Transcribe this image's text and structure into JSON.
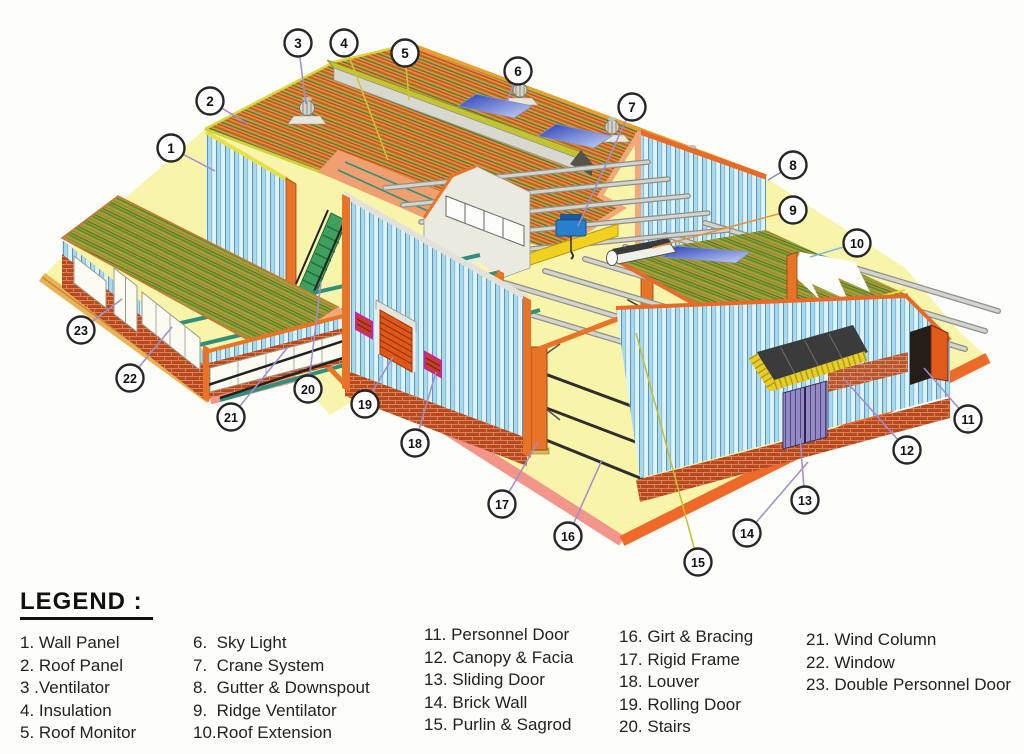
{
  "legend": {
    "heading": "LEGEND :",
    "columns": [
      {
        "items": [
          "1. Wall Panel",
          "2. Roof Panel",
          "3 .Ventilator",
          "4. Insulation",
          "5. Roof Monitor"
        ]
      },
      {
        "items": [
          "6.  Sky Light",
          "7.  Crane System",
          "8.  Gutter & Downspout",
          "9.  Ridge Ventilator",
          "10.Roof Extension"
        ]
      },
      {
        "items": [
          "11. Personnel Door",
          "12. Canopy & Facia",
          "13. Sliding Door",
          "14. Brick Wall",
          "15. Purlin & Sagrod"
        ]
      },
      {
        "items": [
          "16. Girt & Bracing",
          "17. Rigid Frame",
          "18. Louver",
          "19. Rolling Door",
          "20. Stairs"
        ]
      },
      {
        "items": [
          "21. Wind Column",
          "22. Window",
          "23. Double Personnel Door"
        ]
      }
    ]
  },
  "callouts": [
    {
      "num": "1",
      "label": "Wall Panel",
      "cx": 171,
      "cy": 148,
      "tx": 215,
      "ty": 171,
      "line": "#a08cd0"
    },
    {
      "num": "2",
      "label": "Roof Panel",
      "cx": 210,
      "cy": 101,
      "tx": 248,
      "ty": 124,
      "line": "#a08cd0"
    },
    {
      "num": "3",
      "label": "Ventilator",
      "cx": 298,
      "cy": 43,
      "tx": 306,
      "ty": 104,
      "line": "#a08cd0"
    },
    {
      "num": "4",
      "label": "Insulation",
      "cx": 344,
      "cy": 43,
      "tx": 388,
      "ty": 160,
      "line": "#d2c430"
    },
    {
      "num": "5",
      "label": "Roof Monitor",
      "cx": 405,
      "cy": 53,
      "tx": 409,
      "ty": 100,
      "line": "#d2c430"
    },
    {
      "num": "6",
      "label": "Sky Light",
      "cx": 518,
      "cy": 71,
      "tx": 507,
      "ty": 102,
      "line": "#a08cd0"
    },
    {
      "num": "7",
      "label": "Crane System",
      "cx": 632,
      "cy": 107,
      "tx": 578,
      "ty": 226,
      "line": "#a08cd0"
    },
    {
      "num": "8",
      "label": "Gutter & Downspout",
      "cx": 793,
      "cy": 165,
      "tx": 768,
      "ty": 180,
      "line": "#8a8ad0"
    },
    {
      "num": "9",
      "label": "Ridge Ventilator",
      "cx": 793,
      "cy": 210,
      "tx": 652,
      "ty": 248,
      "line": "#e8913c"
    },
    {
      "num": "10",
      "label": "Roof Extension",
      "cx": 857,
      "cy": 243,
      "tx": 810,
      "ty": 257,
      "line": "#7ab8e0"
    },
    {
      "num": "11",
      "label": "Personnel Door",
      "cx": 968,
      "cy": 419,
      "tx": 924,
      "ty": 368,
      "line": "#a08cd0"
    },
    {
      "num": "12",
      "label": "Canopy & Facia",
      "cx": 907,
      "cy": 450,
      "tx": 845,
      "ty": 380,
      "line": "#a08cd0"
    },
    {
      "num": "13",
      "label": "Sliding Door",
      "cx": 805,
      "cy": 500,
      "tx": 800,
      "ty": 438,
      "line": "#a08cd0"
    },
    {
      "num": "14",
      "label": "Brick Wall",
      "cx": 747,
      "cy": 533,
      "tx": 808,
      "ty": 462,
      "line": "#a08cd0"
    },
    {
      "num": "15",
      "label": "Purlin & Sagrod",
      "cx": 698,
      "cy": 562,
      "tx": 636,
      "ty": 333,
      "line": "#c6c030"
    },
    {
      "num": "16",
      "label": "Girt & Bracing",
      "cx": 568,
      "cy": 536,
      "tx": 602,
      "ty": 460,
      "line": "#a08cd0"
    },
    {
      "num": "17",
      "label": "Rigid Frame",
      "cx": 502,
      "cy": 504,
      "tx": 538,
      "ty": 442,
      "line": "#a08cd0"
    },
    {
      "num": "18",
      "label": "Louver",
      "cx": 415,
      "cy": 443,
      "tx": 436,
      "ty": 372,
      "line": "#a08cd0"
    },
    {
      "num": "19",
      "label": "Rolling Door",
      "cx": 365,
      "cy": 404,
      "tx": 393,
      "ty": 357,
      "line": "#a08cd0"
    },
    {
      "num": "20",
      "label": "Stairs",
      "cx": 308,
      "cy": 389,
      "tx": 321,
      "ty": 282,
      "line": "#a08cd0"
    },
    {
      "num": "21",
      "label": "Wind Column",
      "cx": 231,
      "cy": 417,
      "tx": 288,
      "ty": 347,
      "line": "#a08cd0"
    },
    {
      "num": "22",
      "label": "Window",
      "cx": 130,
      "cy": 378,
      "tx": 172,
      "ty": 327,
      "line": "#a08cd0"
    },
    {
      "num": "23",
      "label": "Double Personnel Door",
      "cx": 81,
      "cy": 330,
      "tx": 122,
      "ty": 299,
      "line": "#a08cd0"
    }
  ],
  "colors": {
    "roof_orange": "#dd9440",
    "roof_green": "#95a83c",
    "wall_blue": "#a9d9ea",
    "brick_red": "#b5491f",
    "frame_orange": "#e87428",
    "slab_yellow": "#f8f5ab",
    "slab_edge_orange": "#ef6a28",
    "slab_edge_pink": "#f2968c",
    "crane_yellow": "#f0d020",
    "hoist_blue": "#2880cc",
    "canopy_facia_yellow": "#e8ce2a",
    "sliding_door_purple": "#938ac4",
    "monitor_top": "#c2c434",
    "callout_ring": "#262626"
  }
}
